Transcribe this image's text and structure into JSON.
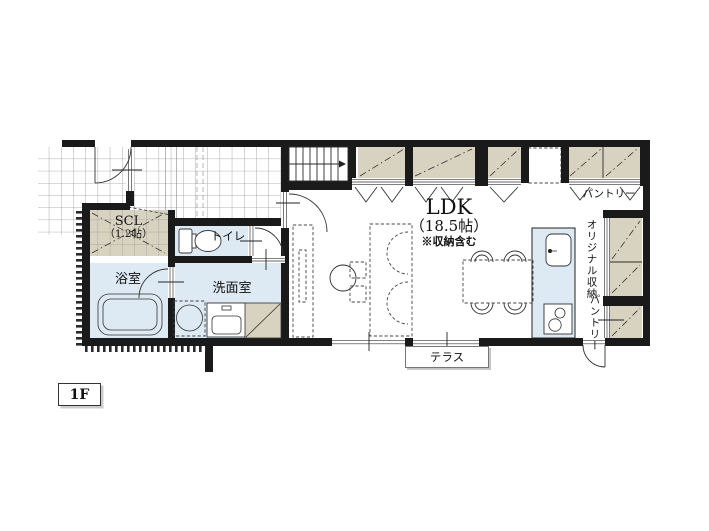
{
  "floor_label": "1F",
  "rooms": {
    "scl": {
      "name": "SCL",
      "size": "（1.2帖）"
    },
    "toilet": {
      "name": "トイレ"
    },
    "bath": {
      "name": "浴室"
    },
    "washroom": {
      "name": "洗面室"
    },
    "ldk": {
      "name": "LDK",
      "size": "（18.5帖）",
      "note": "※収納含む"
    },
    "pantry_top": {
      "name": "パントリー"
    },
    "original_storage": {
      "name": "オリジナル収納"
    },
    "pantry_side": {
      "name": "パントリー"
    },
    "terrace": {
      "name": "テラス"
    }
  },
  "colors": {
    "wall": "#1a1a1a",
    "room_fill": "#dde9f3",
    "closet_fill": "#d8d3c0",
    "grid_line": "#9a9a9a"
  }
}
